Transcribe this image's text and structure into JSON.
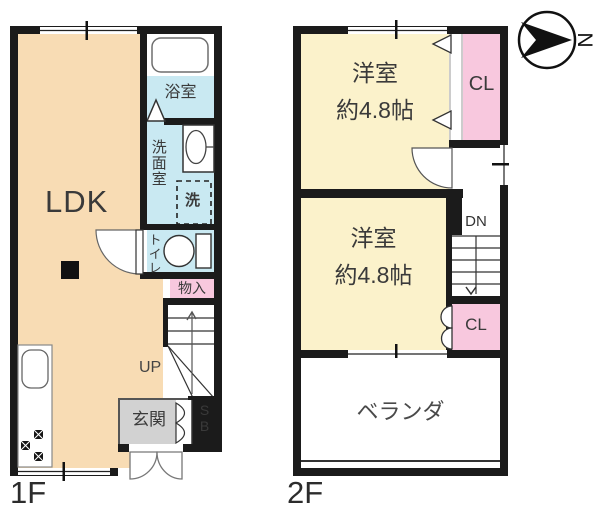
{
  "floor1": {
    "name": "1F",
    "ldk": "LDK",
    "bath": "浴室",
    "washroom": "洗面室",
    "washer": "洗",
    "toilet": "トイレ",
    "storage": "物入",
    "stairs_up": "UP",
    "entrance": "玄関",
    "shoebox_top": "S",
    "shoebox_bottom": "B"
  },
  "floor2": {
    "name": "2F",
    "room1_name": "洋室",
    "room1_size": "約4.8帖",
    "closet1": "CL",
    "room2_name": "洋室",
    "room2_size": "約4.8帖",
    "closet2": "CL",
    "stairs_down": "DN",
    "veranda": "ベランダ"
  },
  "compass": {
    "north": "N"
  },
  "colors": {
    "wall": "#1b1b1b",
    "ldk": "#f8dcb4",
    "western_room": "#fbf2cb",
    "closet": "#f8c8de",
    "wet_area": "#c9e9f2",
    "entrance": "#d2d2d2"
  }
}
